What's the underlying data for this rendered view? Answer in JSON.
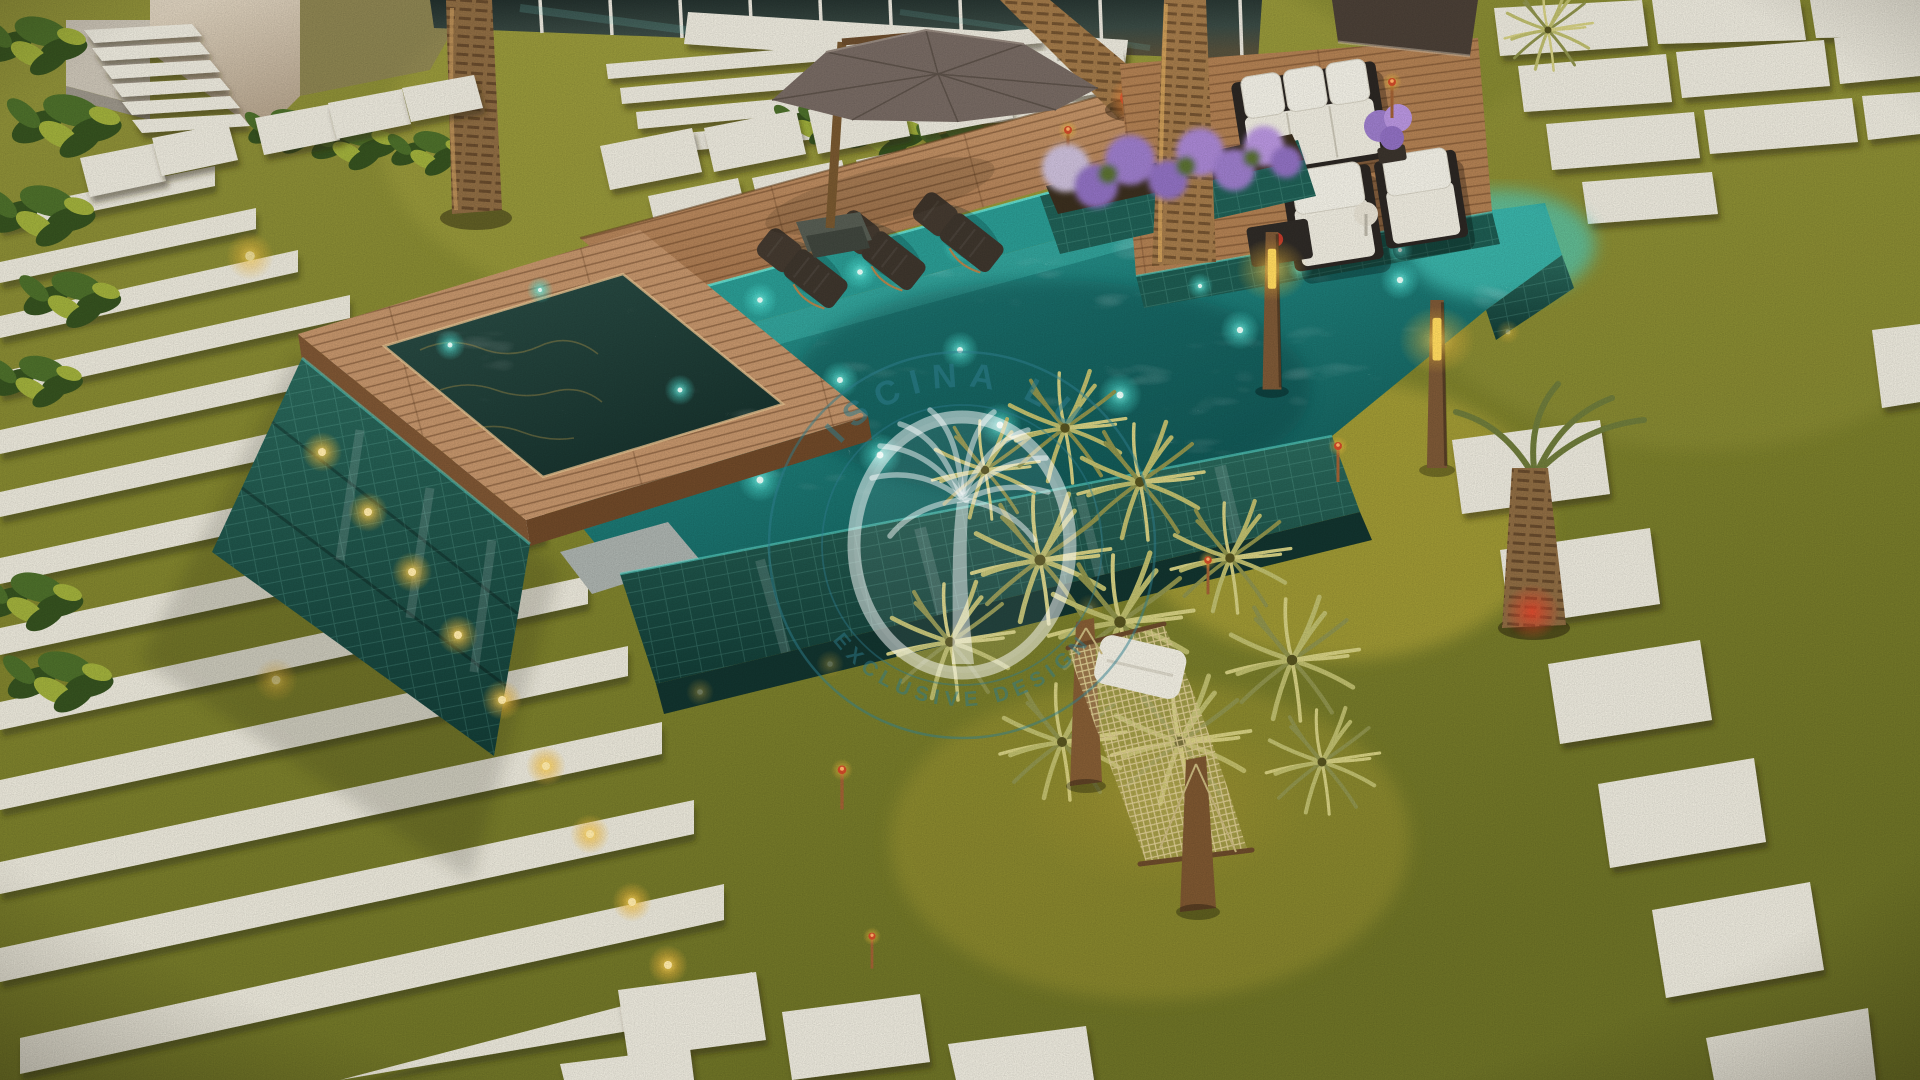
{
  "scene": {
    "title": "Luxury backyard pool landscape - aerial dusk 3D render",
    "type": "3d-architectural-render",
    "lighting": "dusk with warm step lights and cyan underwater lights"
  },
  "watermark": {
    "top_text": "PISCINA LUX",
    "bottom_text": "EXCLUSIVE DESIGN",
    "emblem": "palm-tree-icon",
    "ring_color": "#2e7b8b",
    "emblem_color": "#ffffff"
  },
  "palette": {
    "grass": "#86882f",
    "grass_shade": "#6d7226",
    "paver": "#e9e6da",
    "wood_deck": "#b8895c",
    "spa_frame_wood": "#c2936a",
    "pool_water": "#2f9e97",
    "pool_water_deep": "#10514f",
    "tile_wall": "#1d5a50",
    "spa_water": "#24413b",
    "cushion_white": "#ece9dd",
    "furniture_frame": "#2b2622",
    "wicker": "#43392f",
    "umbrella": "#766962",
    "lavender": "#9b7cc9",
    "spiky_leaf": "#b5b564",
    "monstera": "#3f5c23",
    "hammock_net": "#d9c98f",
    "warm_light": "#ffd95e",
    "cyan_light": "#4fe3d6"
  },
  "objects": {
    "house": "modern house corner with glass wall",
    "entry_steps": "floating concrete entry steps",
    "lawn_terraces": "terraced lawn with white step edges",
    "stepping_stones": "white concrete stepping pavers",
    "pool": "elevated infinity pool with glass-tile walls",
    "spa": "raised square spa with wood coping",
    "tanning_shelf": "in-pool ledge with loungers",
    "sun_loungers": "dark wicker sun loungers",
    "umbrella": "cantilever patio umbrella",
    "planter": "tiled planter with lavender and palms",
    "lounge_deck": "wood deck with white cushioned lounge set",
    "hammock": "woven hammock on wood posts",
    "spiky_plants": "variegated spiky shrubs",
    "light_posts": "wood bollard lights",
    "torches": "copper garden torches",
    "palms": "palm trunks",
    "monstera": "monstera hedge and border plants",
    "watermark": "circular palm-tree watermark badge"
  }
}
